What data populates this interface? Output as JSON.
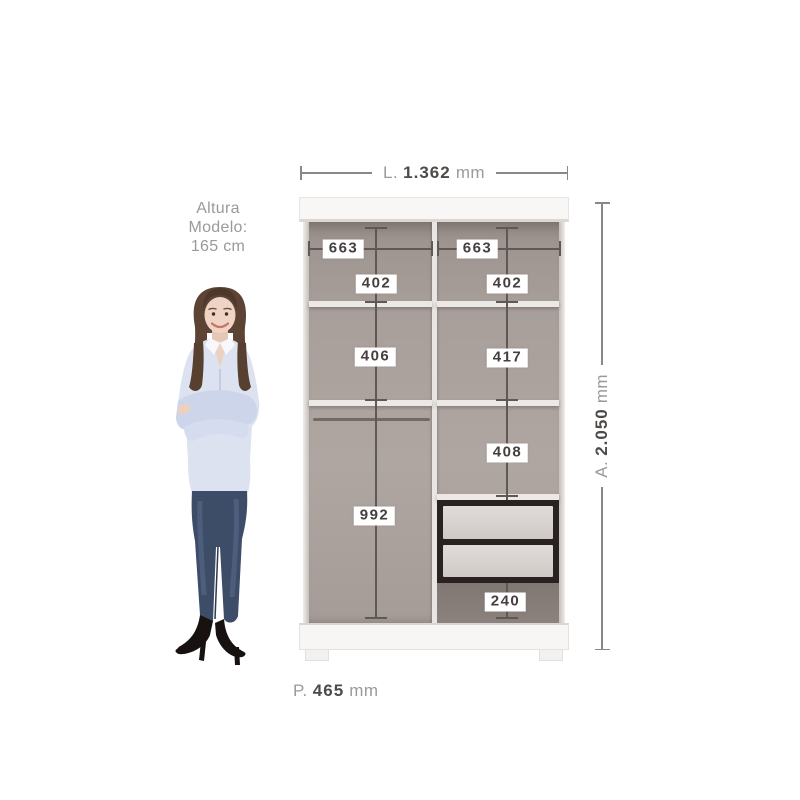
{
  "model_note": {
    "lines": [
      "Altura",
      "Modelo:",
      "165 cm"
    ]
  },
  "dimensions": {
    "width": {
      "prefix": "L.",
      "value": "1.362",
      "unit": "mm"
    },
    "height": {
      "prefix": "A.",
      "value": "2.050",
      "unit": "mm"
    },
    "depth": {
      "prefix": "P.",
      "value": "465",
      "unit": "mm"
    }
  },
  "internal_measurements": {
    "left_top_width": "663",
    "right_top_width": "663",
    "left_upper_height": "402",
    "right_upper_height": "402",
    "left_middle_height": "406",
    "right_middle_height": "417",
    "right_lower_height": "408",
    "left_hanging_height": "992",
    "right_bottom_height": "240"
  },
  "colors": {
    "background": "#ffffff",
    "cabinet_panel": "#f8f7f5",
    "interior": "#a89f9b",
    "interior_dark_zone": "#8b827e",
    "shelf": "#ece8e5",
    "drawer_frame": "#2a2220",
    "drawer_front": "#d8d3d0",
    "dimension_line": "#5f5955",
    "outer_dimension_line": "#8b8784",
    "label_text": "#45403f",
    "muted_text": "#9c9a98",
    "hair": "#5c4334",
    "skin": "#efd3c5",
    "shirt": "#dde2f1",
    "jeans": "#3d4d68",
    "shoes": "#17120f"
  }
}
